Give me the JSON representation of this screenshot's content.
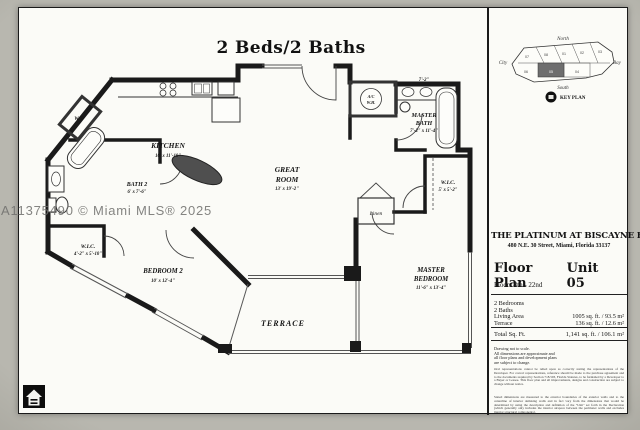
{
  "watermark": "A11375490 © Miami MLS® 2025",
  "title": "2 Beds/2 Baths",
  "floorplan": {
    "kitchen_name": "KITCHEN",
    "kitchen_dims": "10' x 11'-10\"",
    "bath2_name": "BATH 2",
    "bath2_dims": "6' x 7'-6\"",
    "wic2_name": "W.I.C.",
    "wic2_dims": "4'-2\" x 5'-10\"",
    "bedroom2_name": "BEDROOM 2",
    "bedroom2_dims": "10' x 12'-4\"",
    "great1": "GREAT",
    "great2": "ROOM",
    "great_dims": "13' x 19'-2\"",
    "terrace": "TERRACE",
    "mbath1": "MASTER",
    "mbath2": "BATH",
    "mbath_dims": "7'-2\" x 11'-4\"",
    "mbed1": "MASTER",
    "mbed2": "BEDROOM",
    "mbed_dims": "11'-6\" x 13'-4\"",
    "mwic_name": "W.I.C.",
    "mwic_dims": "5' x 5'-2\"",
    "linen": "Linen",
    "wd": "W/D",
    "ac": "A/C",
    "wh": "W.H.",
    "dim_top": "7'-2\""
  },
  "keyplan": {
    "north": "North",
    "south": "South",
    "city": "City",
    "bay": "Bay",
    "label": "KEY PLAN",
    "units_top": [
      "07",
      "08",
      "01",
      "02",
      "03"
    ],
    "units_bottom": [
      "06",
      "05",
      "04"
    ]
  },
  "panel": {
    "building": "THE PLATINUM AT BISCAYNE BAY",
    "address": "480 N.E. 30 Street, Miami, Florida 33137",
    "plan_label": "Floor Plan",
    "unit_label": "Unit 05",
    "floors": "Floors 8th - 22nd",
    "bedrooms": "2 Bedrooms",
    "baths": "2 Baths",
    "living_label": "Living Area",
    "living_value": "1005 sq. ft. /  93.5 m²",
    "terrace_label": "Terrace",
    "terrace_value": "136 sq. ft. /  12.6 m²",
    "total_label": "Total Sq. Ft.",
    "total_value": "1,141 sq. ft. / 106.1 m²",
    "disclaimer_lines": [
      "Drawing not to scale.",
      "All dimensions are approximate and",
      "all floor plans and development plans",
      "are subject to change."
    ],
    "disclaimer_p1": "Oral representations cannot be relied upon as correctly stating the representations of the Developer. For correct representations, reference should be made to the purchase agreement and to the documents required by Section 718.503, Florida Statutes, to be furnished by a Developer to a Buyer or Lessee. This floor plan and all improvements, designs and construction are subject to change without notice.",
    "disclaimer_p2": "Stated dimensions are measured to the exterior boundaries of the exterior walls and to the centerline of interior demising walls and in fact vary from the dimensions that would be determined by using the description and definition of the \"Unit\" set forth in the Declaration (which generally only includes the interior airspace between the perimeter walls and excludes interior structural components)."
  }
}
